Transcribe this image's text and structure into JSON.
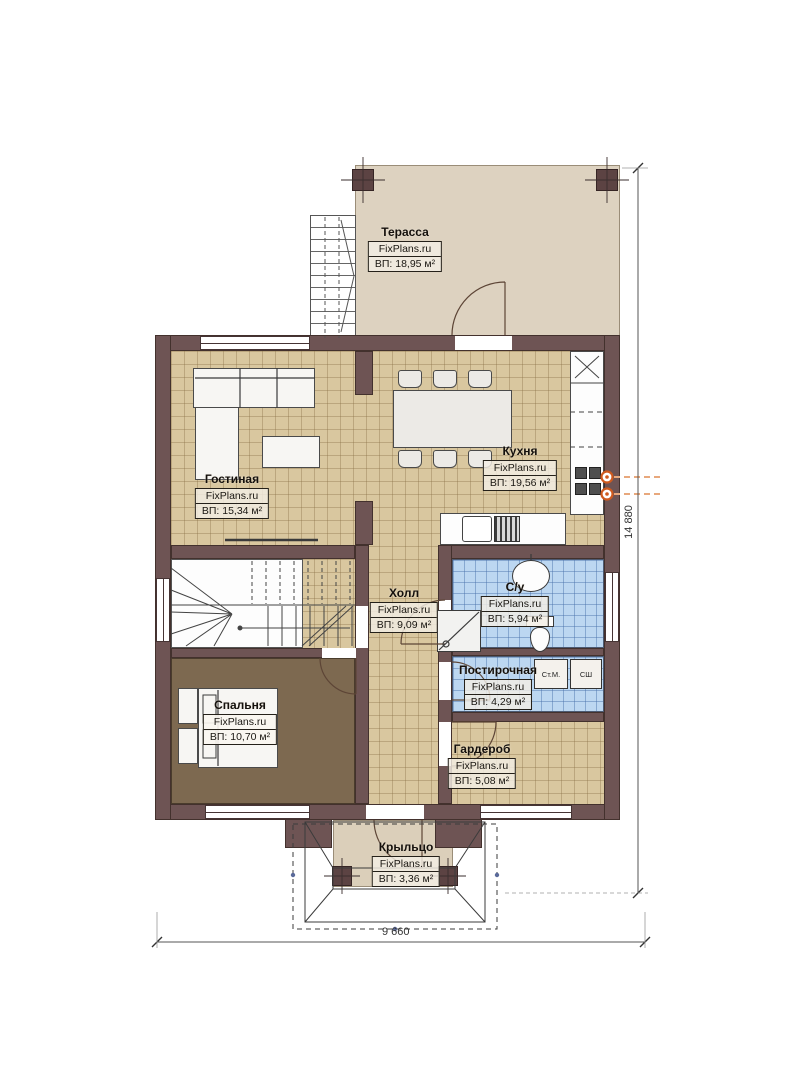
{
  "watermark": "FixPlans.ru",
  "rooms": [
    {
      "name": "Терасса",
      "area": "ВП: 18,95 м²"
    },
    {
      "name": "Кухня",
      "area": "ВП: 19,56 м²"
    },
    {
      "name": "Гостиная",
      "area": "ВП: 15,34 м²"
    },
    {
      "name": "Холл",
      "area": "ВП: 9,09 м²"
    },
    {
      "name": "С/у",
      "area": "ВП: 5,94 м²"
    },
    {
      "name": "Постирочная",
      "area": "ВП: 4,29 м²"
    },
    {
      "name": "Спальня",
      "area": "ВП: 10,70 м²"
    },
    {
      "name": "Гардероб",
      "area": "ВП: 5,08 м²"
    },
    {
      "name": "Крыльцо",
      "area": "ВП: 3,36 м²"
    }
  ],
  "appliances": {
    "washing_machine": "Ст.М.",
    "dryer": "СШ"
  },
  "dimensions": {
    "overall_width": "9 660",
    "overall_depth": "14 880"
  },
  "colors": {
    "wall": "#6e5454",
    "floor_tile": "#d9c79f",
    "floor_wet": "#bcd7f1",
    "floor_bedroom": "#7d6950",
    "terrace": "#ddd2c0",
    "utility_accent": "#cf5a1e"
  }
}
